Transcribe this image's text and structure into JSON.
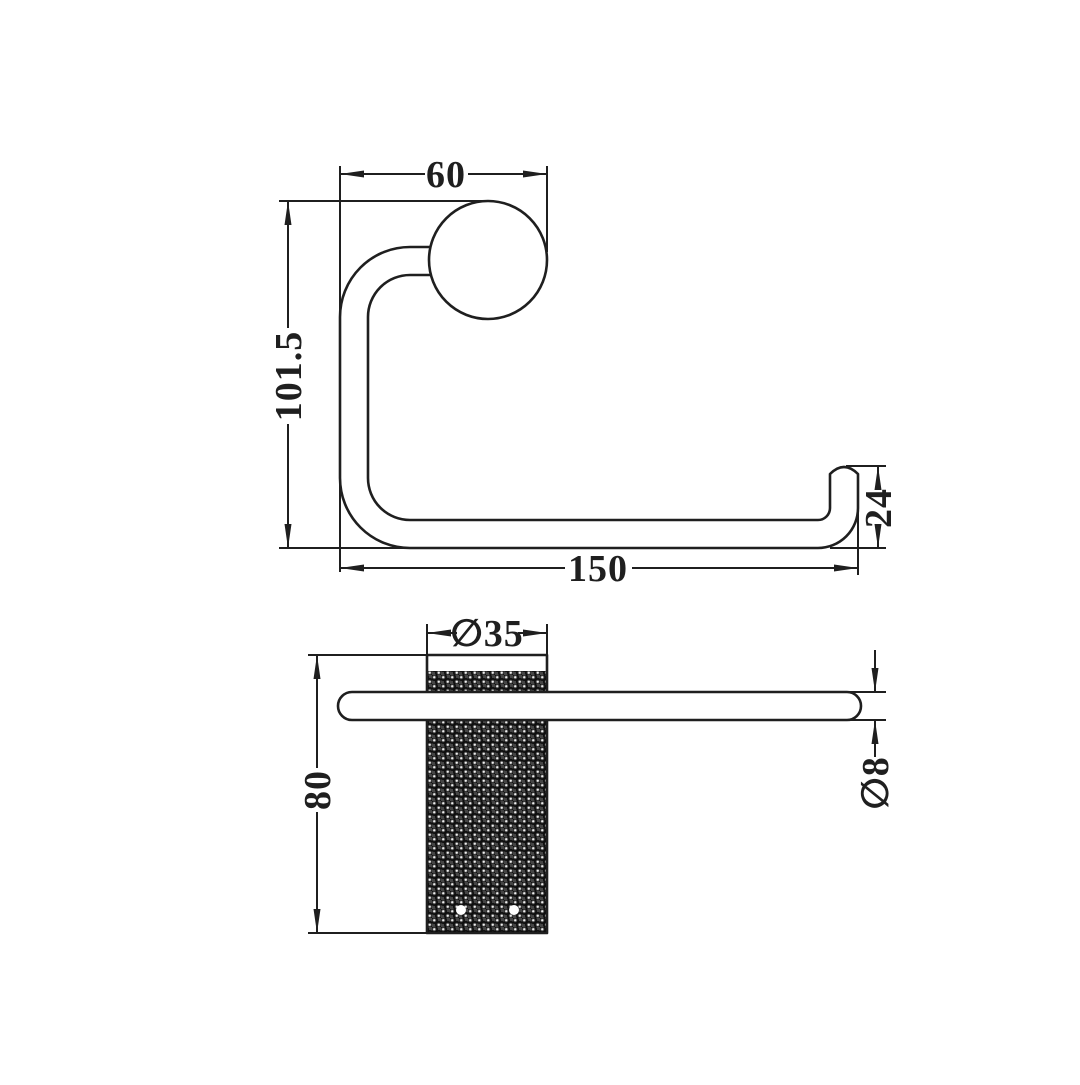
{
  "front_view": {
    "dim_top_width": "60",
    "dim_height": "101.5",
    "dim_bottom_width": "150",
    "dim_lip_height": "24"
  },
  "side_view": {
    "dim_post_diameter": "∅35",
    "dim_post_height": "80",
    "dim_bar_diameter": "∅8"
  },
  "colors": {
    "line": "#1f1f1f",
    "background": "#ffffff",
    "knurl_base": "#454545",
    "knurl_ring": "#0e0e0e",
    "knurl_dot": "#ededed"
  }
}
